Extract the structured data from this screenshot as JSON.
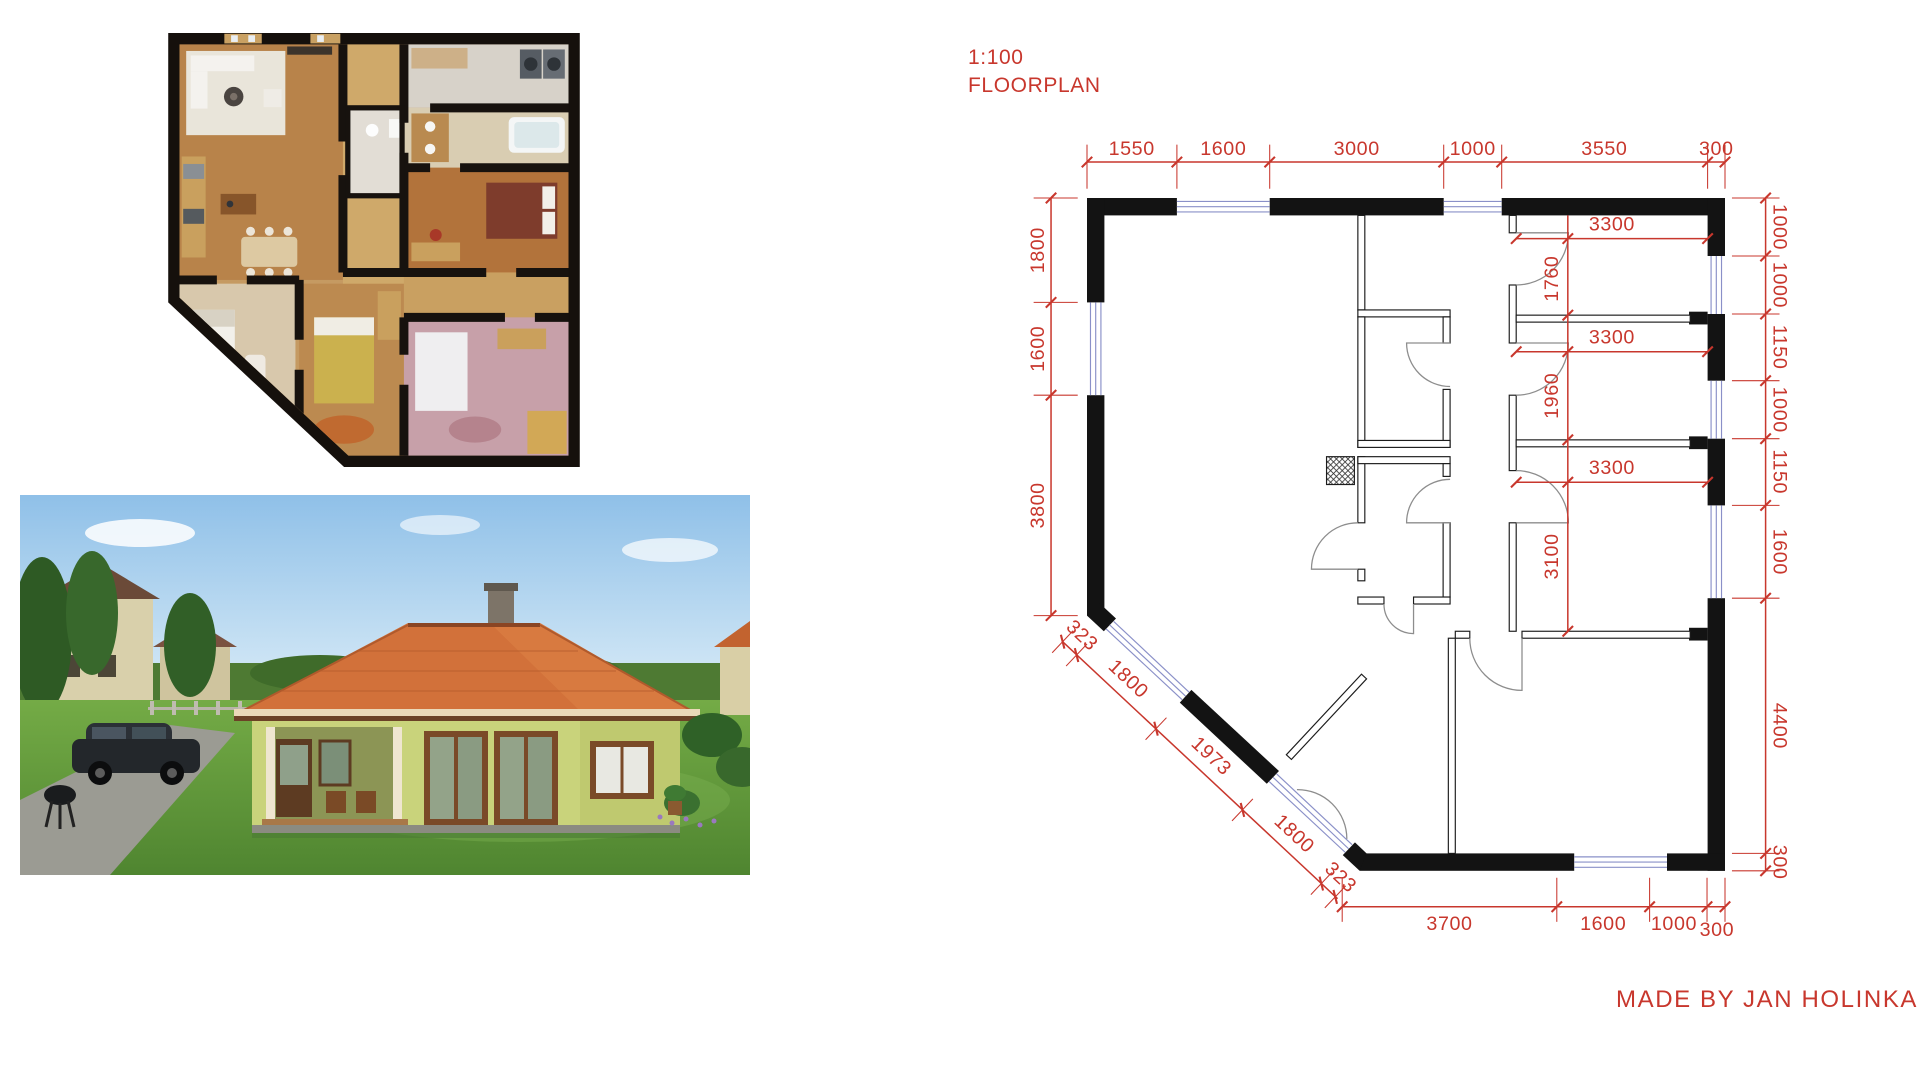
{
  "plan": {
    "scale_label": "1:100",
    "type_label": "FLOORPLAN",
    "credit": "MADE BY JAN HOLINKA",
    "colors": {
      "dimension_red": "#c8372d",
      "wall_black": "#131313",
      "window_blue": "#8a90c8"
    },
    "dims": {
      "top": [
        "1550",
        "1600",
        "3000",
        "1000",
        "3550",
        "300"
      ],
      "left": [
        "1800",
        "1600",
        "3800"
      ],
      "diagonal": [
        "323",
        "1800",
        "1973",
        "1800",
        "323"
      ],
      "bottom": [
        "3700",
        "1600",
        "1000",
        "300"
      ],
      "right": [
        "1000",
        "1000",
        "1150",
        "1000",
        "1150",
        "1600",
        "4400",
        "300"
      ],
      "interior": {
        "room1_width": "3300",
        "room1_depth": "1760",
        "room2_width": "3300",
        "room2_depth": "1960",
        "room3_width": "3300",
        "room3_depth": "3100"
      }
    }
  }
}
